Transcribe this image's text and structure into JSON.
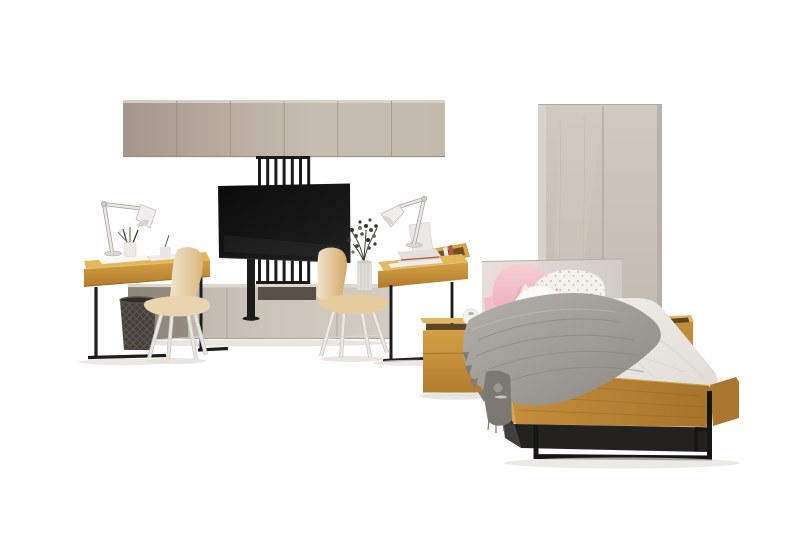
{
  "meta": {
    "type": "furniture-product-photo",
    "subject": "youth bedroom furniture set with oak and black metal accents",
    "canvas": {
      "width": 800,
      "height": 533
    }
  },
  "palette": {
    "background": "#ffffff",
    "cabinet": "#bcb0a3",
    "cabinet_dark": "#a3958a",
    "slat_metal": "#1b1b1b",
    "tv": "#111111",
    "sideboard": "#c6beb4",
    "recess": "#575047",
    "wardrobe": "#c9c3b9",
    "oak_top": "#e3b75c",
    "oak_front": "#c08a35",
    "oak_dark": "#9a6c2a",
    "oak_slot": "#5d4521",
    "rail_oak": "#b5812f",
    "chair_shell": "#e6cb9d",
    "chair_seat": "#e8d4ae",
    "chair_leg": "#ebe8e3",
    "lamp": "#f0eeea",
    "basket": "#46403a",
    "plant": "#39412f",
    "vase": "#e1ddd7",
    "headboard": "#ddd6d0",
    "pillow_pink": "#f2c3ca",
    "pillow_white": "#fcfbf9",
    "pillow_pattern": "#f5f2ee",
    "rainbow_cream": "#eddcc0",
    "rainbow_yellow": "#e7c97b",
    "rainbow_white": "#eae8e3",
    "rainbow_silver": "#a9b1b7",
    "rainbow_dark": "#5b564f",
    "blanket": "#a09d98",
    "blanket_dark": "#7c7974",
    "bedding": "#efede8",
    "bed_metal": "#161616",
    "glass_amber": "#9a5420",
    "shadow": "#e3e0dc"
  },
  "objects": [
    {
      "id": "wall-cabinet-row",
      "label": "six-door wall cabinet row"
    },
    {
      "id": "slat-panel",
      "label": "black vertical slat TV panel"
    },
    {
      "id": "tv",
      "label": "flat screen television"
    },
    {
      "id": "tv-stand-column",
      "label": "black TV mount column"
    },
    {
      "id": "sideboard",
      "label": "low media sideboard"
    },
    {
      "id": "wardrobe",
      "label": "two-door wardrobe"
    },
    {
      "id": "desk-left",
      "label": "oak desk with black sled legs"
    },
    {
      "id": "desk-right",
      "label": "oak desk with organizer tray"
    },
    {
      "id": "lamp-left",
      "label": "white articulated desk lamp"
    },
    {
      "id": "lamp-right",
      "label": "white articulated desk lamp"
    },
    {
      "id": "chair-left",
      "label": "beige shell chair"
    },
    {
      "id": "chair-right",
      "label": "tan shell chair"
    },
    {
      "id": "wire-basket",
      "label": "dark wire basket"
    },
    {
      "id": "laptop",
      "label": "laptop on book stack"
    },
    {
      "id": "plant",
      "label": "dried plant in ribbed vase"
    },
    {
      "id": "bed",
      "label": "single bed, oak frame, black metal base"
    },
    {
      "id": "headboard",
      "label": "upholstered light headboard"
    },
    {
      "id": "blanket",
      "label": "gray knit throw blanket"
    },
    {
      "id": "pillow-pink",
      "label": "pink pillow"
    },
    {
      "id": "pillow-patterned",
      "label": "white patterned pillow"
    },
    {
      "id": "pillow-plush",
      "label": "white plush pillow"
    },
    {
      "id": "rainbow-cushion",
      "label": "rainbow plush cushion"
    },
    {
      "id": "nightstand-left",
      "label": "oak nightstand with open tray"
    },
    {
      "id": "nightstand-right",
      "label": "oak nightstand with amber glass"
    }
  ]
}
